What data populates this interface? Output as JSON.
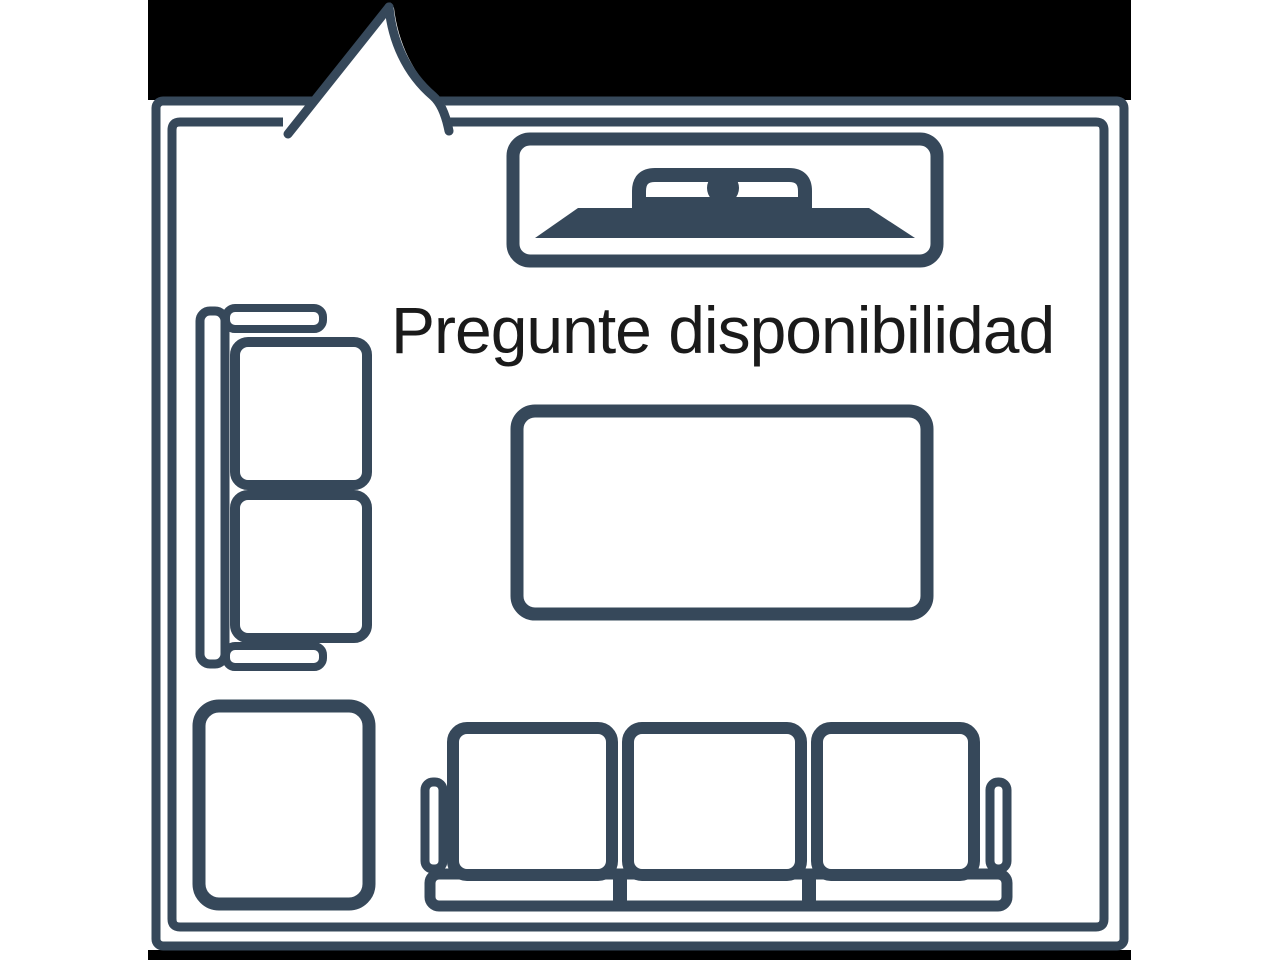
{
  "annotation": {
    "text": "Pregunte disponibilidad"
  },
  "colors": {
    "wall": "#36485A",
    "banner": "#000000",
    "background": "#FFFFFF",
    "text": "#1A1A1A"
  },
  "diagram": {
    "kind": "living-room-floor-plan-in-speech-bubble",
    "banner_top": true,
    "banner_bottom_strip": true,
    "furniture_icons": [
      {
        "id": "tv-console-icon"
      },
      {
        "id": "loveseat-icon"
      },
      {
        "id": "coffee-table-icon"
      },
      {
        "id": "ottoman-icon"
      },
      {
        "id": "sofa-icon"
      }
    ]
  }
}
